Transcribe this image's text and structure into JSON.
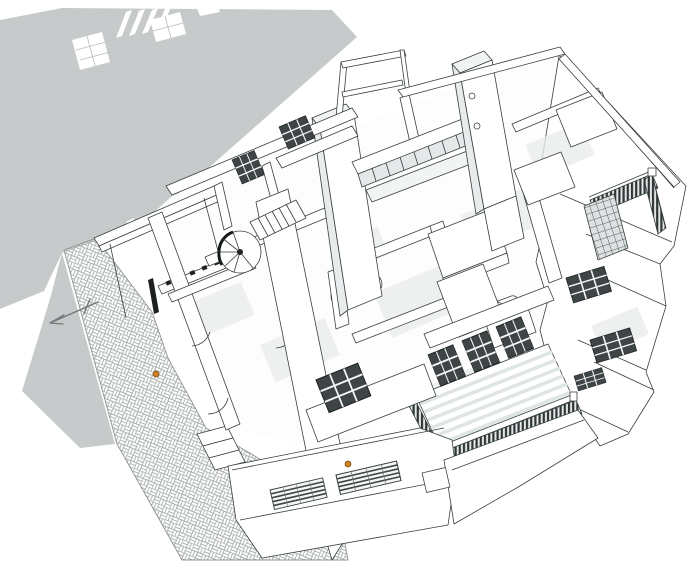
{
  "meta": {
    "kind": "architectural-3d-rendering",
    "description": "Axonometric cutaway view of a modernist house model (roof removed) showing interior rooms, two chimney towers, a clerestory window band, a spiral staircase, furniture, balconies with slatted railings, a basket-weave paved terrace, a cast shadow on the ground and a small north arrow."
  },
  "colors": {
    "bg": "#ffffff",
    "line": "#383f3f",
    "shadow": "#c7caca",
    "face-white": "#ffffff",
    "face-light": "#f2f4f4",
    "face-mid": "#e9ecec",
    "floor-band": "#e8eceb",
    "window-dark": "#3f4546",
    "mullion": "#f5f7f7",
    "slat-dark": "#2f3636",
    "slat-bg": "#e6e9e9",
    "paving-line": "#a6abab",
    "accent-orange": "#cd7d22",
    "arrow-gray": "#707777"
  },
  "scene": {
    "cast_shadow": "large gray ground shadow upper-left with light window-pattern cutouts",
    "paving": "diagonal basket-weave paved terrace strip, lower-left",
    "north_arrow": "thin open arrow on the ground, pointing lower-left",
    "towers": 2,
    "clerestory_panes": 8,
    "spiral_stair": "curved stair with dark treads, center-left",
    "straight_stair": "stepped flight beside spiral stair",
    "balconies": "slatted-railing balconies bottom-center and upper-right",
    "facade_windows": "dark gridded windows on all street facades",
    "markers": "two small orange figures/markers"
  }
}
